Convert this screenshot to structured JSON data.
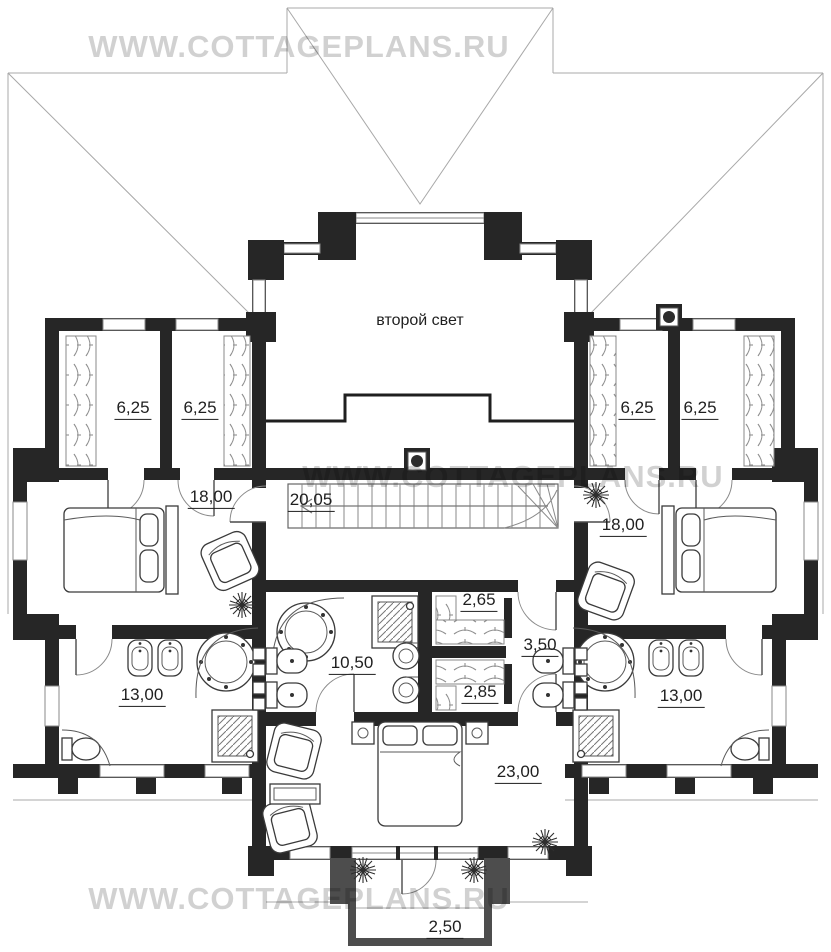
{
  "watermark": {
    "text": "WWW.COTTAGEPLANS.RU"
  },
  "plan": {
    "second_light_label": "второй свет"
  },
  "rooms": [
    {
      "name": "closet-left-outer",
      "area": "6,25",
      "x": 133,
      "y": 410
    },
    {
      "name": "closet-left-inner",
      "area": "6,25",
      "x": 200,
      "y": 410
    },
    {
      "name": "closet-right-inner",
      "area": "6,25",
      "x": 637,
      "y": 410
    },
    {
      "name": "closet-right-outer",
      "area": "6,25",
      "x": 700,
      "y": 410
    },
    {
      "name": "bedroom-left",
      "area": "18,00",
      "x": 211,
      "y": 499
    },
    {
      "name": "hall",
      "area": "20,05",
      "x": 311,
      "y": 502
    },
    {
      "name": "bedroom-right",
      "area": "18,00",
      "x": 623,
      "y": 527
    },
    {
      "name": "bathroom-left",
      "area": "13,00",
      "x": 142,
      "y": 697
    },
    {
      "name": "bathroom-center",
      "area": "10,50",
      "x": 352,
      "y": 665
    },
    {
      "name": "closet-center-top",
      "area": "2,65",
      "x": 479,
      "y": 602
    },
    {
      "name": "corridor",
      "area": "3,50",
      "x": 540,
      "y": 647
    },
    {
      "name": "closet-center-bottom",
      "area": "2,85",
      "x": 480,
      "y": 694
    },
    {
      "name": "bathroom-right",
      "area": "13,00",
      "x": 681,
      "y": 698
    },
    {
      "name": "master-bedroom",
      "area": "23,00",
      "x": 518,
      "y": 774
    },
    {
      "name": "balcony",
      "area": "2,50",
      "x": 445,
      "y": 929
    }
  ],
  "colors": {
    "wall": "#262626",
    "balcony_wall": "#4d4d4d",
    "roof_line": "#a8a8a8",
    "furniture_line": "#3a3a3a",
    "label_text": "#1f1f1f",
    "watermark": "rgba(0,0,0,0.18)"
  }
}
